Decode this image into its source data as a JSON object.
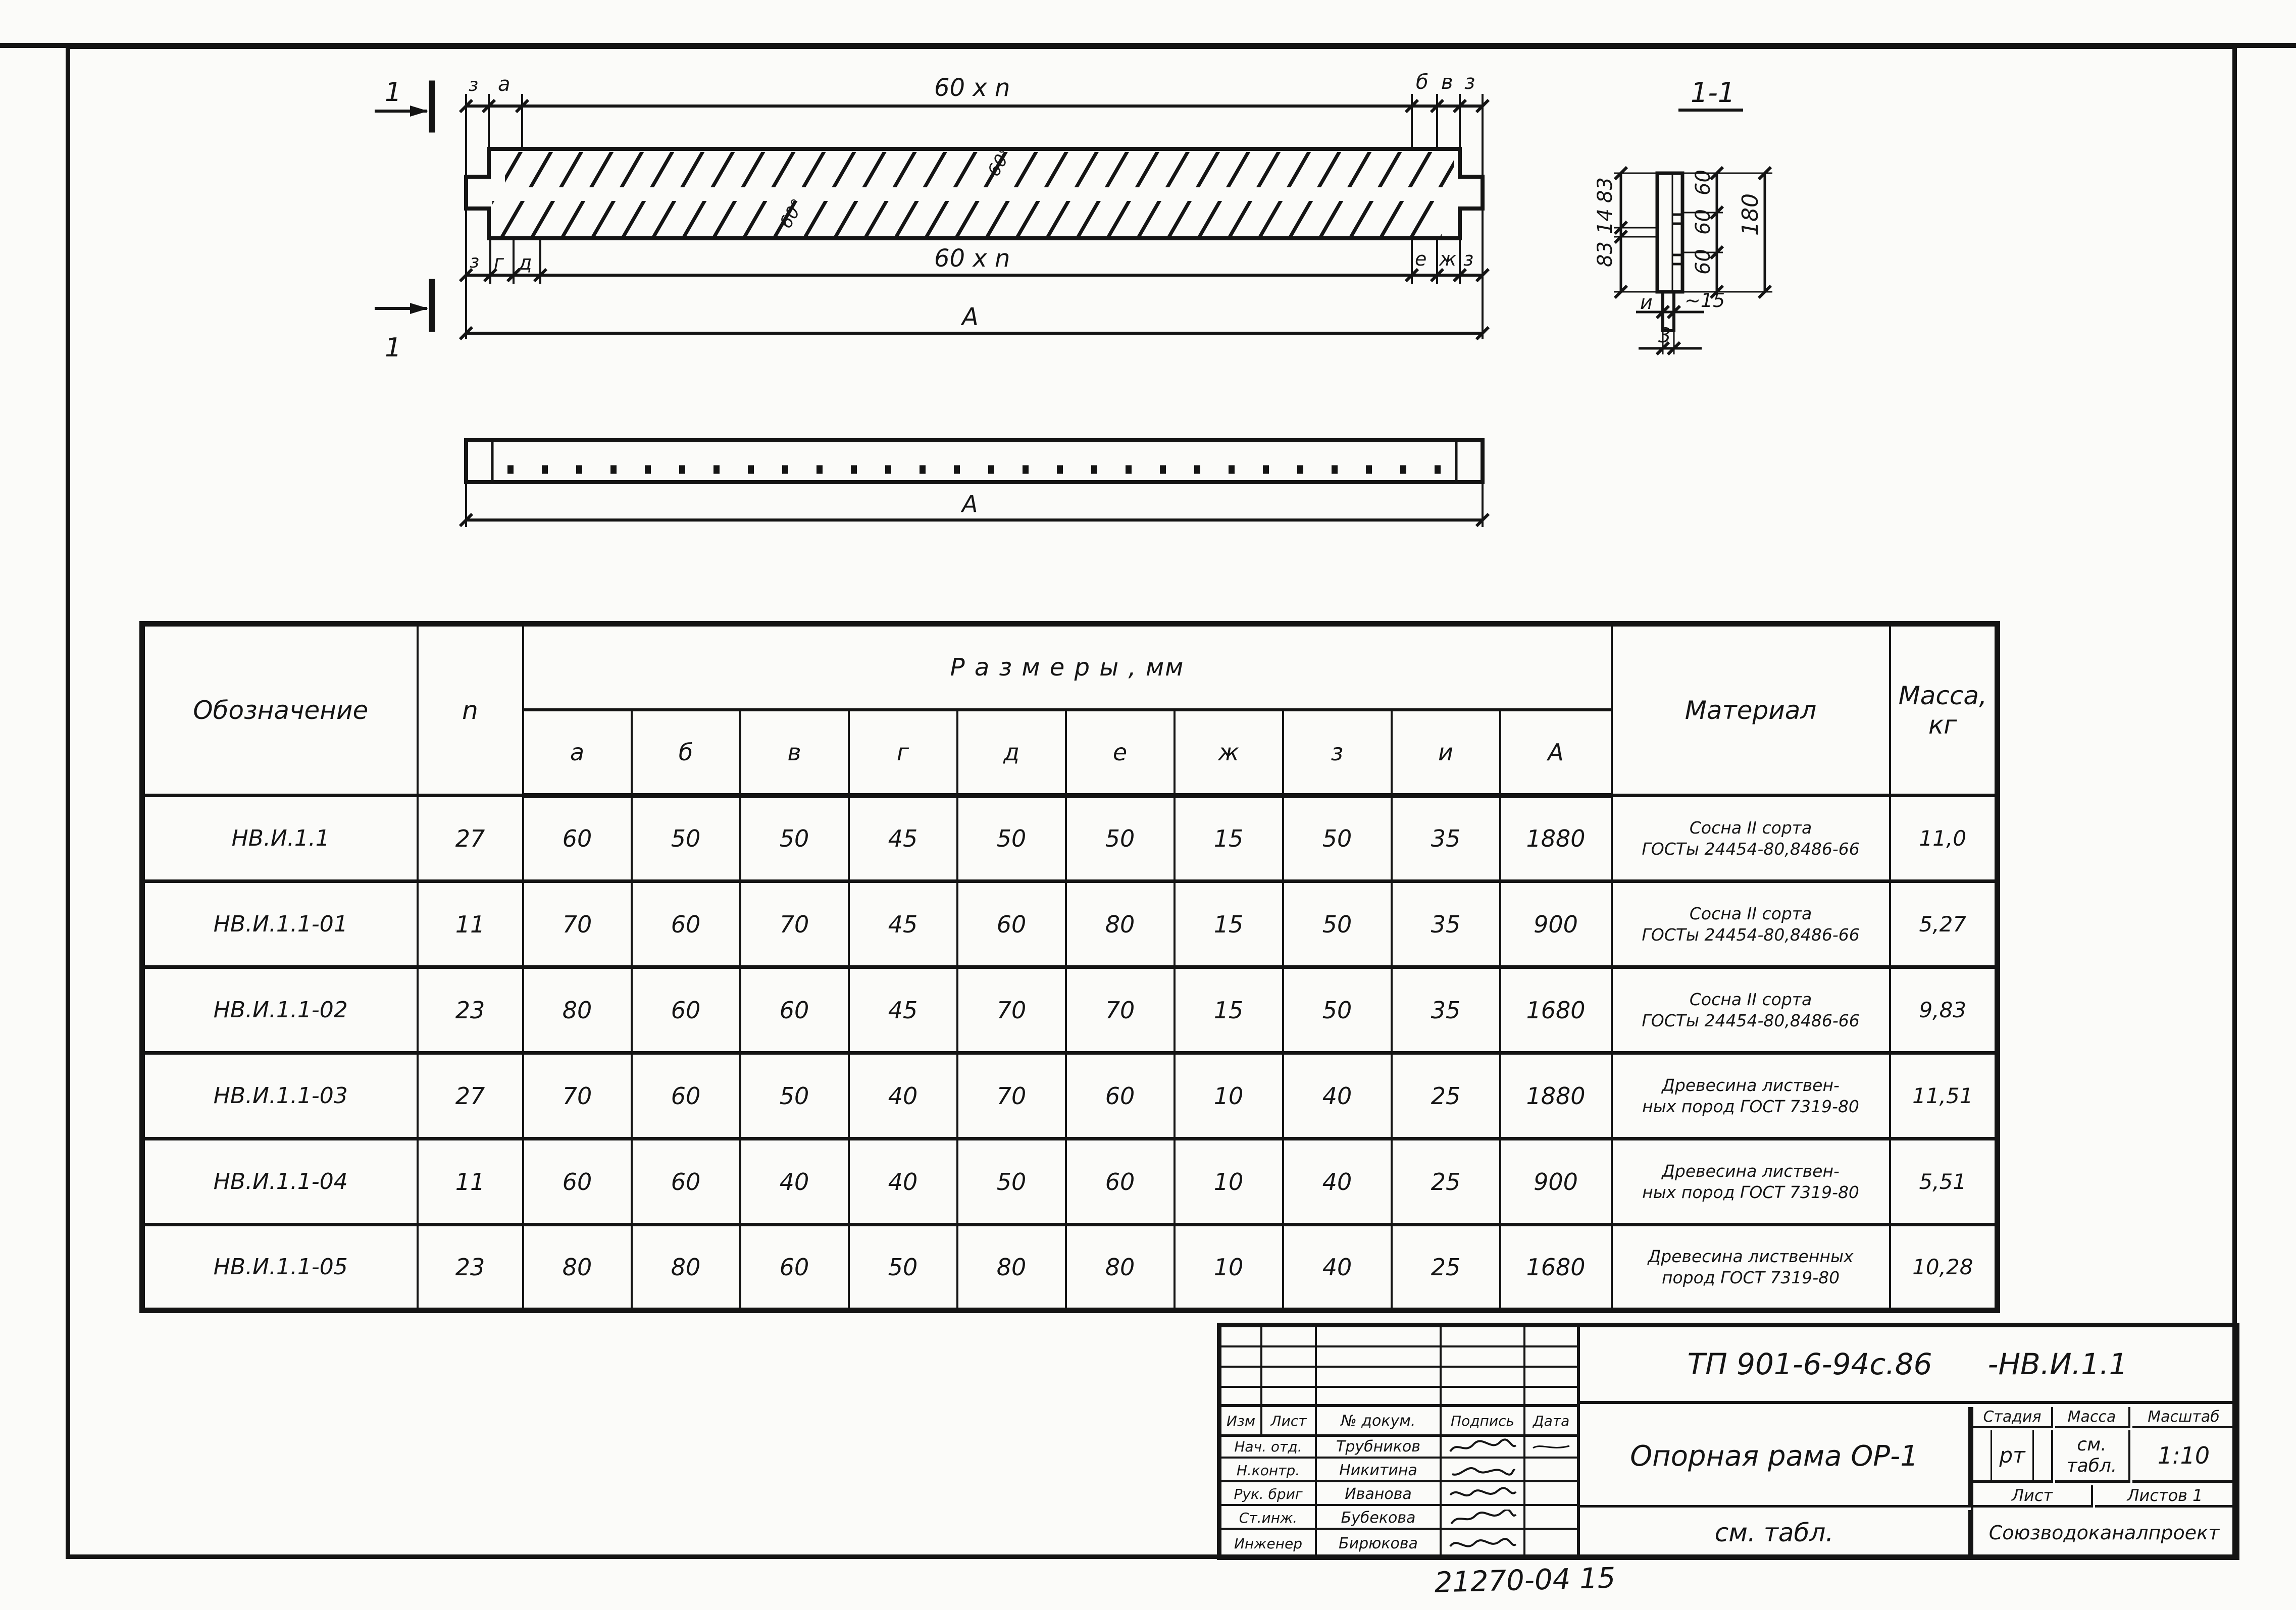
{
  "page": {
    "footer_number": "21270-04 15"
  },
  "front_view": {
    "section_label_top": "1",
    "section_label_bottom": "1",
    "top_dims": {
      "z1": "з",
      "a": "а",
      "span": "60 x n",
      "b": "б",
      "v": "в",
      "z2": "з"
    },
    "bottom_dims": {
      "z1": "з",
      "g": "г",
      "d": "д",
      "span": "60 x n",
      "e": "е",
      "zh": "ж",
      "z2": "з"
    },
    "overall": "А",
    "angle_top": "60°",
    "angle_bottom": "60°"
  },
  "plan_view": {
    "overall": "А"
  },
  "section_view": {
    "title": "1-1",
    "left_dims": [
      "83",
      "14",
      "83"
    ],
    "right_dims": [
      "60",
      "60",
      "60"
    ],
    "overall": "180",
    "tab_width_left": "и",
    "tab_width_right": "~15",
    "tab_thickness": "3"
  },
  "table": {
    "headers": {
      "designation": "Обозначение",
      "n": "n",
      "sizes": "Р а з м е р ы ,  мм",
      "size_cols": [
        "а",
        "б",
        "в",
        "г",
        "д",
        "е",
        "ж",
        "з",
        "и",
        "А"
      ],
      "material": "Материал",
      "mass_line1": "Масса,",
      "mass_line2": "кг"
    },
    "rows": [
      {
        "name": "НВ.И.1.1",
        "n": "27",
        "sizes": [
          "60",
          "50",
          "50",
          "45",
          "50",
          "50",
          "15",
          "50",
          "35",
          "1880"
        ],
        "material1": "Сосна II сорта",
        "material2": "ГОСТы 24454-80,8486-66",
        "mass": "11,0"
      },
      {
        "name": "НВ.И.1.1-01",
        "n": "11",
        "sizes": [
          "70",
          "60",
          "70",
          "45",
          "60",
          "80",
          "15",
          "50",
          "35",
          "900"
        ],
        "material1": "Сосна II сорта",
        "material2": "ГОСТы 24454-80,8486-66",
        "mass": "5,27"
      },
      {
        "name": "НВ.И.1.1-02",
        "n": "23",
        "sizes": [
          "80",
          "60",
          "60",
          "45",
          "70",
          "70",
          "15",
          "50",
          "35",
          "1680"
        ],
        "material1": "Сосна II сорта",
        "material2": "ГОСТы 24454-80,8486-66",
        "mass": "9,83"
      },
      {
        "name": "НВ.И.1.1-03",
        "n": "27",
        "sizes": [
          "70",
          "60",
          "50",
          "40",
          "70",
          "60",
          "10",
          "40",
          "25",
          "1880"
        ],
        "material1": "Древесина листвен-",
        "material2": "ных пород ГОСТ 7319-80",
        "mass": "11,51"
      },
      {
        "name": "НВ.И.1.1-04",
        "n": "11",
        "sizes": [
          "60",
          "60",
          "40",
          "40",
          "50",
          "60",
          "10",
          "40",
          "25",
          "900"
        ],
        "material1": "Древесина листвен-",
        "material2": "ных пород ГОСТ 7319-80",
        "mass": "5,51"
      },
      {
        "name": "НВ.И.1.1-05",
        "n": "23",
        "sizes": [
          "80",
          "80",
          "60",
          "50",
          "80",
          "80",
          "10",
          "40",
          "25",
          "1680"
        ],
        "material1": "Древесина лиственных",
        "material2": "пород ГОСТ 7319-80",
        "mass": "10,28"
      }
    ]
  },
  "stamp": {
    "doc_code": "ТП 901-6-94с.86",
    "doc_code2": "-НВ.И.1.1",
    "rev_headers": [
      "Изм",
      "Лист",
      "№ докум.",
      "Подпись",
      "Дата"
    ],
    "rows": [
      {
        "role": "Нач. отд.",
        "name": "Трубников"
      },
      {
        "role": "Н.контр.",
        "name": "Никитина"
      },
      {
        "role": "Рук. бриг",
        "name": "Иванова"
      },
      {
        "role": "Ст.инж.",
        "name": "Бубекова"
      },
      {
        "role": "Инженер",
        "name": "Бирюкова"
      }
    ],
    "title": "Опорная рама ОР-1",
    "stage_label": "Стадия",
    "mass_label": "Масса",
    "scale_label": "Масштаб",
    "stage": "рт",
    "mass1": "см.",
    "mass2": "табл.",
    "scale": "1:10",
    "sheet_label": "Лист",
    "sheets_label": "Листов 1",
    "see_table": "см. табл.",
    "organization": "Союзводоканалпроект"
  }
}
